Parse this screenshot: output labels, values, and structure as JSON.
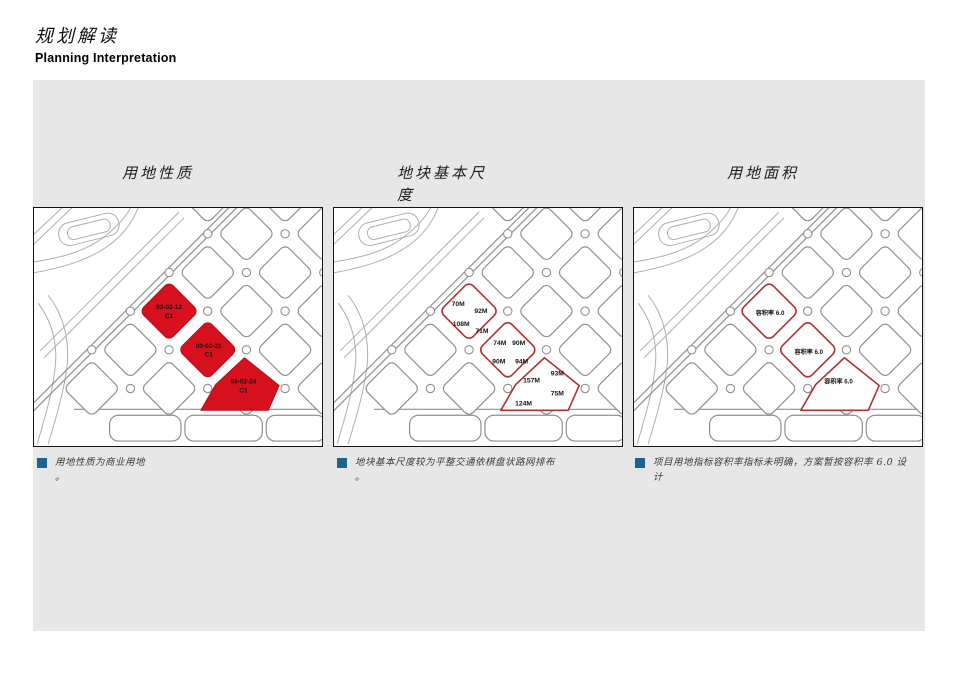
{
  "header": {
    "title_zh": "规划解读",
    "title_en": "Planning Interpretation"
  },
  "panels": [
    {
      "title": "用地性质",
      "caption": "用地性质为商业用地\n。",
      "parcels": [
        {
          "code": "03-02-12",
          "use": "C1"
        },
        {
          "code": "03-02-21",
          "use": "C1"
        },
        {
          "code": "03-02-24",
          "use": "C1"
        }
      ]
    },
    {
      "title": "地块基本尺度",
      "caption": "地块基本尺度较为平整交通依棋盘状路网排布\n。",
      "dims": [
        "70M",
        "92M",
        "108M",
        "71M",
        "74M",
        "90M",
        "90M",
        "94M",
        "157M",
        "93M",
        "75M",
        "124M"
      ]
    },
    {
      "title": "用地面积",
      "caption": "项目用地指标容积率指标未明确，方案暂按容积率 6.0 设\n计",
      "far": [
        "容积率 6.0",
        "容积率 6.0",
        "容积率 6.0"
      ]
    }
  ],
  "colors": {
    "panel_bg": "#e7e7e7",
    "parcel_red": "#d6101d",
    "outline_red": "#b23030",
    "bullet_blue": "#1d6390"
  }
}
